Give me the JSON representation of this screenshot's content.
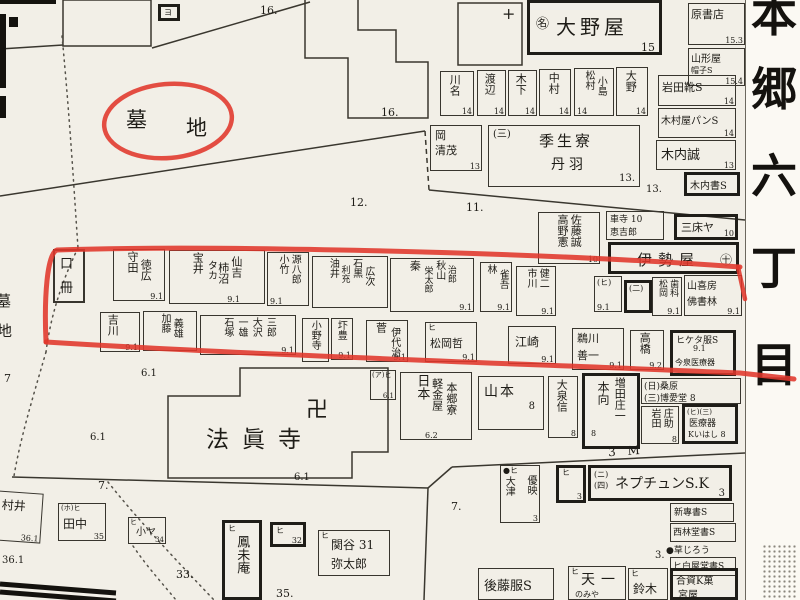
{
  "region": {
    "strip": [
      "本",
      "郷",
      "六",
      "丁",
      "目"
    ]
  },
  "t": {
    "temple": "法眞寺",
    "manji": "卍",
    "bochi1": "墓",
    "bochi2": "地",
    "edge1": "墓",
    "edge2": "地",
    "plus": "+"
  },
  "n": {
    "a16": "16.",
    "b16": "16.",
    "a12": "12.",
    "a11": "11.",
    "a13": "13.",
    "a7": "7",
    "b7": "7.",
    "c7": "7.",
    "a33": "33.",
    "a35": "35.",
    "a361": "36.1",
    "a61a": "6.1",
    "a61b": "6.1",
    "a61c": "6.1",
    "a3": "3.",
    "a3m": "3 M"
  },
  "b": {
    "yo": {
      "mark": "ヨ"
    },
    "oonoya": {
      "mark": "㊔",
      "name": "大野屋",
      "num": "15"
    },
    "hara": {
      "name": "原書店",
      "num": "15.3"
    },
    "yamagata": {
      "l1": "山形屋",
      "l2": "帽子S",
      "num": "15.4"
    },
    "kawana": {
      "c1": "川名",
      "num": "14"
    },
    "watanabe": {
      "c1": "渡辺",
      "num": "14"
    },
    "kinoshita": {
      "c1": "木下",
      "num": "14"
    },
    "nakamura": {
      "c1": "中村",
      "num": "14"
    },
    "matsumura": {
      "c1": "松村",
      "c2": "小島",
      "num": "14"
    },
    "oono2": {
      "c1": "大野",
      "num": "14"
    },
    "iwata": {
      "name": "岩田靴S",
      "num": "14"
    },
    "kimuraya": {
      "name": "木村屋パンS",
      "num": "14"
    },
    "kiuchi": {
      "name": "木内誠",
      "num": "13"
    },
    "kiuchisho": {
      "name": "木内書S"
    },
    "oka": {
      "l1": "岡",
      "l2": "清茂",
      "num": "13"
    },
    "kisei": {
      "mark": "(三)",
      "l1": "季生寮",
      "l2": "丹羽",
      "num": "13."
    },
    "takano": {
      "c1": "高野憲",
      "n1": "10",
      "c2": "佐藤誠",
      "n2": "10"
    },
    "kuruma": {
      "l1": "車寺 10",
      "l2": "恵吉郎"
    },
    "santoko": {
      "name": "三床ヤ",
      "num": "10"
    },
    "iseya": {
      "name": "伊勢屋",
      "mark": "㊉"
    },
    "kuchi": {
      "c1": "口",
      "c2": "冊"
    },
    "morita": {
      "c1": "守田",
      "c2": "徳広",
      "num": "9.1"
    },
    "takarai": {
      "c1": "宝井",
      "c2": "タカ",
      "c3": "柿沼",
      "c4": "仙吉",
      "num": "9.1"
    },
    "kotake": {
      "c1": "小竹",
      "c2": "源八郎",
      "num": "9.1"
    },
    "yui": {
      "c1": "油井",
      "c2": "利充",
      "c3": "石黒",
      "c4": "広次"
    },
    "hata": {
      "c1": "秦",
      "c2": "栄太郎",
      "c3": "秋山",
      "c4": "治郎",
      "num": "9.1"
    },
    "hayashi": {
      "c1": "林",
      "c2": "雀吾",
      "num": "9.1"
    },
    "ichikawa": {
      "c1": "市川",
      "c2": "健二",
      "num": "9.1"
    },
    "hibox": {
      "mark": "(ヒ)",
      "num": "9.1"
    },
    "nibox": {
      "mark": "(二)"
    },
    "matsuokaS": {
      "c1": "松岡",
      "c2": "歯科",
      "num": "9.1"
    },
    "sankibo": {
      "l1": "山喜房",
      "l2": "佛書林",
      "num": "9.1"
    },
    "yoshikawa": {
      "c1": "吉川",
      "num": "9.1"
    },
    "kato": {
      "c1": "加藤",
      "c2": "義雄"
    },
    "ishizuka": {
      "c1": "石塚",
      "c2": "一雄",
      "c3": "大沢",
      "c4": "三郎",
      "num": "9.1"
    },
    "onodera": {
      "c1": "小野寺"
    },
    "akutsu": {
      "c1": "圷豊",
      "num": "9.1"
    },
    "suga": {
      "c1": "菅",
      "c2": "伊代治",
      "num": "9.1"
    },
    "matsuokaT": {
      "mark": "ヒ",
      "name": "松岡哲",
      "num": "9.1"
    },
    "ezaki": {
      "name": "江崎",
      "num": "9.1"
    },
    "ukawa": {
      "l1": "鵜川",
      "l2": "善一",
      "num": "9.1"
    },
    "takahashi": {
      "c1": "高橋",
      "num": "9.2"
    },
    "hiketa": {
      "l1": "ヒケタ服S",
      "num": "9.1",
      "l2": "今泉医療器"
    },
    "abox": {
      "mark": "(ア)ヒ",
      "num": "6.1"
    },
    "keikin": {
      "c1": "日本",
      "c2": "軽金屋",
      "c3": "本郷寮",
      "num": "6.2"
    },
    "yamamoto": {
      "name": "山本",
      "num": "8"
    },
    "oizumi": {
      "c1": "大泉信",
      "num": "8"
    },
    "honko": {
      "c1": "本向",
      "n1": "8",
      "c2": "増田庄一"
    },
    "kuwabara": {
      "l1": "(日)桑原",
      "l2": "(三)博愛堂 8"
    },
    "iwatasho": {
      "c1": "岩田",
      "c2": "庄助",
      "num": "8"
    },
    "iryoki": {
      "l1": "(ヒ)(三)",
      "l2": "医療器",
      "l3": "Kいはし 8"
    },
    "otsu": {
      "mark": "●ヒ",
      "c1": "大津",
      "c2": "優映",
      "num": "3"
    },
    "hi3": {
      "mark": "ヒ",
      "num": "3"
    },
    "neptune": {
      "m1": "(ニ)",
      "m2": "(四)",
      "name": "ネプチュンS.K",
      "num": "3"
    },
    "shinsen": {
      "name": "新專書S"
    },
    "seirindo": {
      "name": "西林堂書S"
    },
    "kusa": {
      "name": "●草じろう"
    },
    "hakuya": {
      "name": "ヒ白屋堂書S"
    },
    "goto": {
      "name": "後藤服S"
    },
    "tenichi": {
      "mark": "ヒ",
      "name": "天一",
      "sub": "のみや"
    },
    "suzuki": {
      "mark": "ヒ",
      "name": "鈴木"
    },
    "goshi": {
      "l1": "合資K菓",
      "l2": "宮屋"
    },
    "murai": {
      "name": "村井",
      "num": "36.1"
    },
    "tanaka": {
      "mark": "(ホ)ヒ",
      "name": "田中",
      "num": "35"
    },
    "koya": {
      "mark": "ヒ",
      "name": "小ヤ",
      "num": "34"
    },
    "hooan": {
      "mark": "ヒ",
      "name": "鳳未庵"
    },
    "hi32": {
      "mark": "ヒ",
      "num": "32"
    },
    "sekiya": {
      "mark": "ヒ",
      "l1": "関谷 31",
      "l2": "弥太郎"
    }
  },
  "colors": {
    "red": "#e0372b",
    "ink": "#1e1c17",
    "paper": "#f2efe7"
  }
}
